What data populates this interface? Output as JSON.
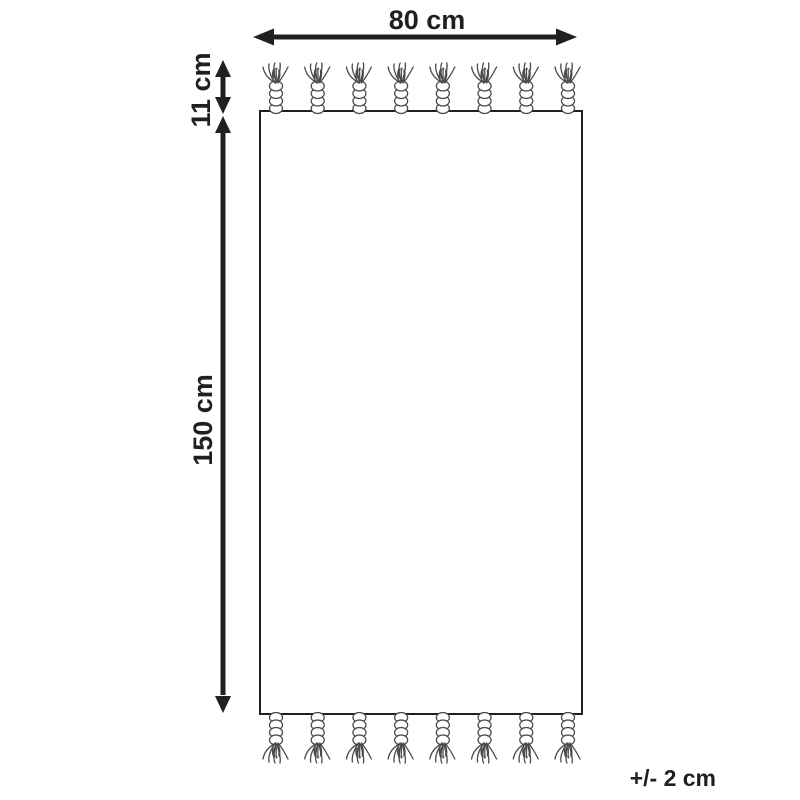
{
  "diagram": {
    "kind": "product-dimension-diagram",
    "subject": "rectangular rug / towel with twisted tassels on top and bottom edges",
    "labels": {
      "width": "80 cm",
      "fringe": "11 cm",
      "length": "150 cm",
      "tolerance": "+/- 2 cm"
    },
    "tassels": {
      "top_count": 8,
      "bottom_count": 8
    },
    "colors": {
      "line": "#231f20",
      "tassel_stroke": "#4a4a4a",
      "background": "#ffffff"
    }
  }
}
